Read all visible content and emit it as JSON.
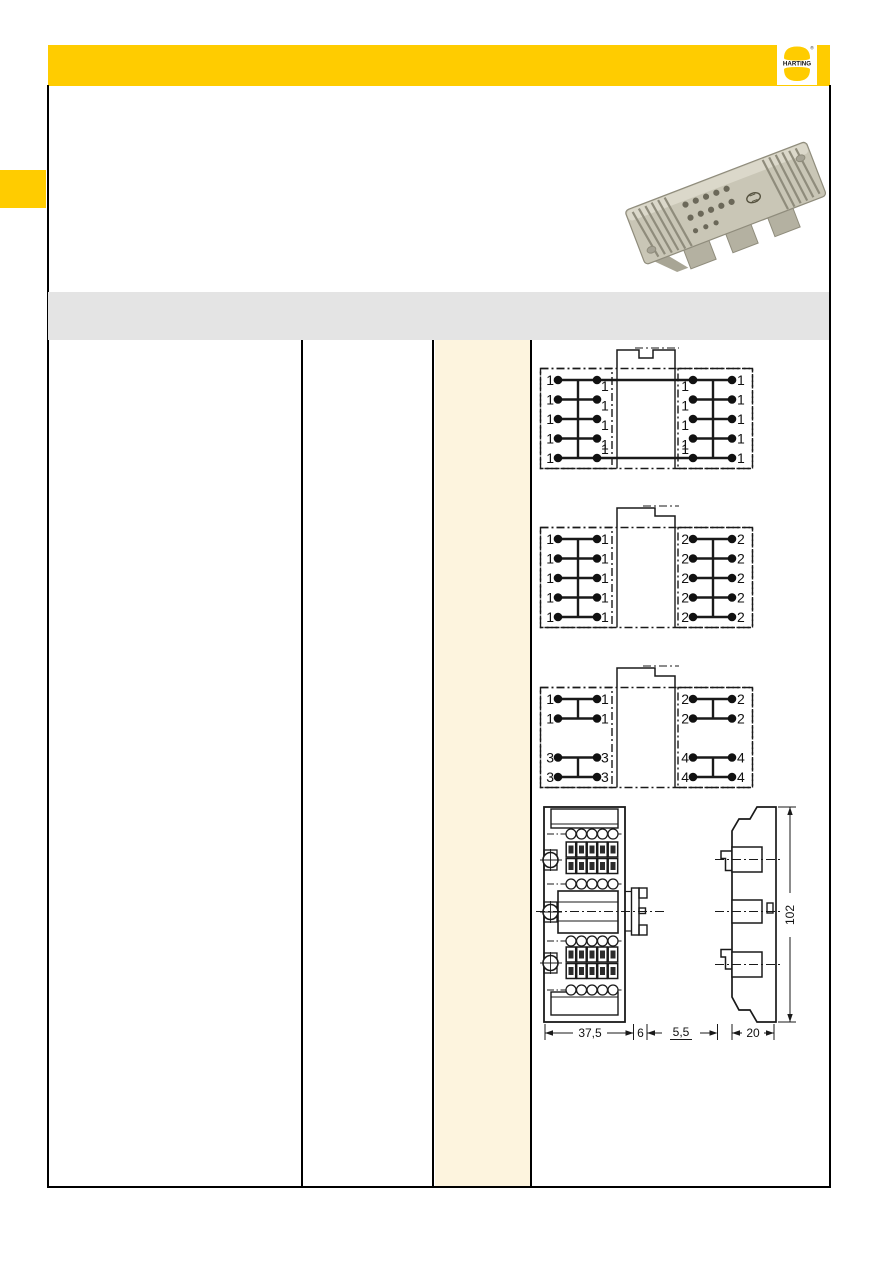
{
  "page": {
    "background": "#ffffff"
  },
  "header": {
    "bar_color": "#FFCC00",
    "logo": {
      "text": "HARTING",
      "registered": "®",
      "bg": "#ffffff",
      "accent": "#FFCC00"
    }
  },
  "left_tab": {
    "color": "#FFCC00"
  },
  "divider_band": {
    "color": "#E4E4E4"
  },
  "table": {
    "highlight_column_color": "#FDF4DE",
    "border_color": "#000000"
  },
  "product_photo": {
    "name": "grey-terminal-block-photo",
    "body_color": "#c9c6b6"
  },
  "schematics": [
    {
      "name": "jumpered-single-potential",
      "tab": "notched",
      "stagger_inner_labels": true,
      "left_bus": [
        [
          0,
          4
        ]
      ],
      "right_bus": [
        [
          0,
          4
        ]
      ],
      "rows": [
        {
          "slot": 0,
          "labels": [
            "1",
            "1",
            "1",
            "1"
          ],
          "cross": true
        },
        {
          "slot": 1,
          "labels": [
            "1",
            "1",
            "1",
            "1"
          ],
          "cross": false
        },
        {
          "slot": 2,
          "labels": [
            "1",
            "1",
            "1",
            "1"
          ],
          "cross": false
        },
        {
          "slot": 3,
          "labels": [
            "1",
            "1",
            "1",
            "1"
          ],
          "cross": false
        },
        {
          "slot": 4,
          "labels": [
            "1",
            "1",
            "1",
            "1"
          ],
          "cross": true
        }
      ]
    },
    {
      "name": "two-potentials",
      "tab": "stepped",
      "stagger_inner_labels": false,
      "left_bus": [
        [
          0,
          4
        ]
      ],
      "right_bus": [
        [
          0,
          4
        ]
      ],
      "rows": [
        {
          "slot": 0,
          "labels": [
            "1",
            "1",
            "2",
            "2"
          ],
          "cross": false
        },
        {
          "slot": 1,
          "labels": [
            "1",
            "1",
            "2",
            "2"
          ],
          "cross": false
        },
        {
          "slot": 2,
          "labels": [
            "1",
            "1",
            "2",
            "2"
          ],
          "cross": false
        },
        {
          "slot": 3,
          "labels": [
            "1",
            "1",
            "2",
            "2"
          ],
          "cross": false
        },
        {
          "slot": 4,
          "labels": [
            "1",
            "1",
            "2",
            "2"
          ],
          "cross": false
        }
      ]
    },
    {
      "name": "four-potentials",
      "tab": "stepped",
      "stagger_inner_labels": false,
      "left_bus": [
        [
          0,
          1
        ],
        [
          3,
          4
        ]
      ],
      "right_bus": [
        [
          0,
          1
        ],
        [
          3,
          4
        ]
      ],
      "rows": [
        {
          "slot": 0,
          "labels": [
            "1",
            "1",
            "2",
            "2"
          ],
          "cross": false
        },
        {
          "slot": 1,
          "labels": [
            "1",
            "1",
            "2",
            "2"
          ],
          "cross": false
        },
        {
          "slot": 3,
          "labels": [
            "3",
            "3",
            "4",
            "4"
          ],
          "cross": false
        },
        {
          "slot": 4,
          "labels": [
            "3",
            "3",
            "4",
            "4"
          ],
          "cross": false
        }
      ]
    }
  ],
  "dimensions": {
    "width": "37,5",
    "offset": "6",
    "lip": "5,5",
    "depth": "20",
    "height": "102"
  }
}
